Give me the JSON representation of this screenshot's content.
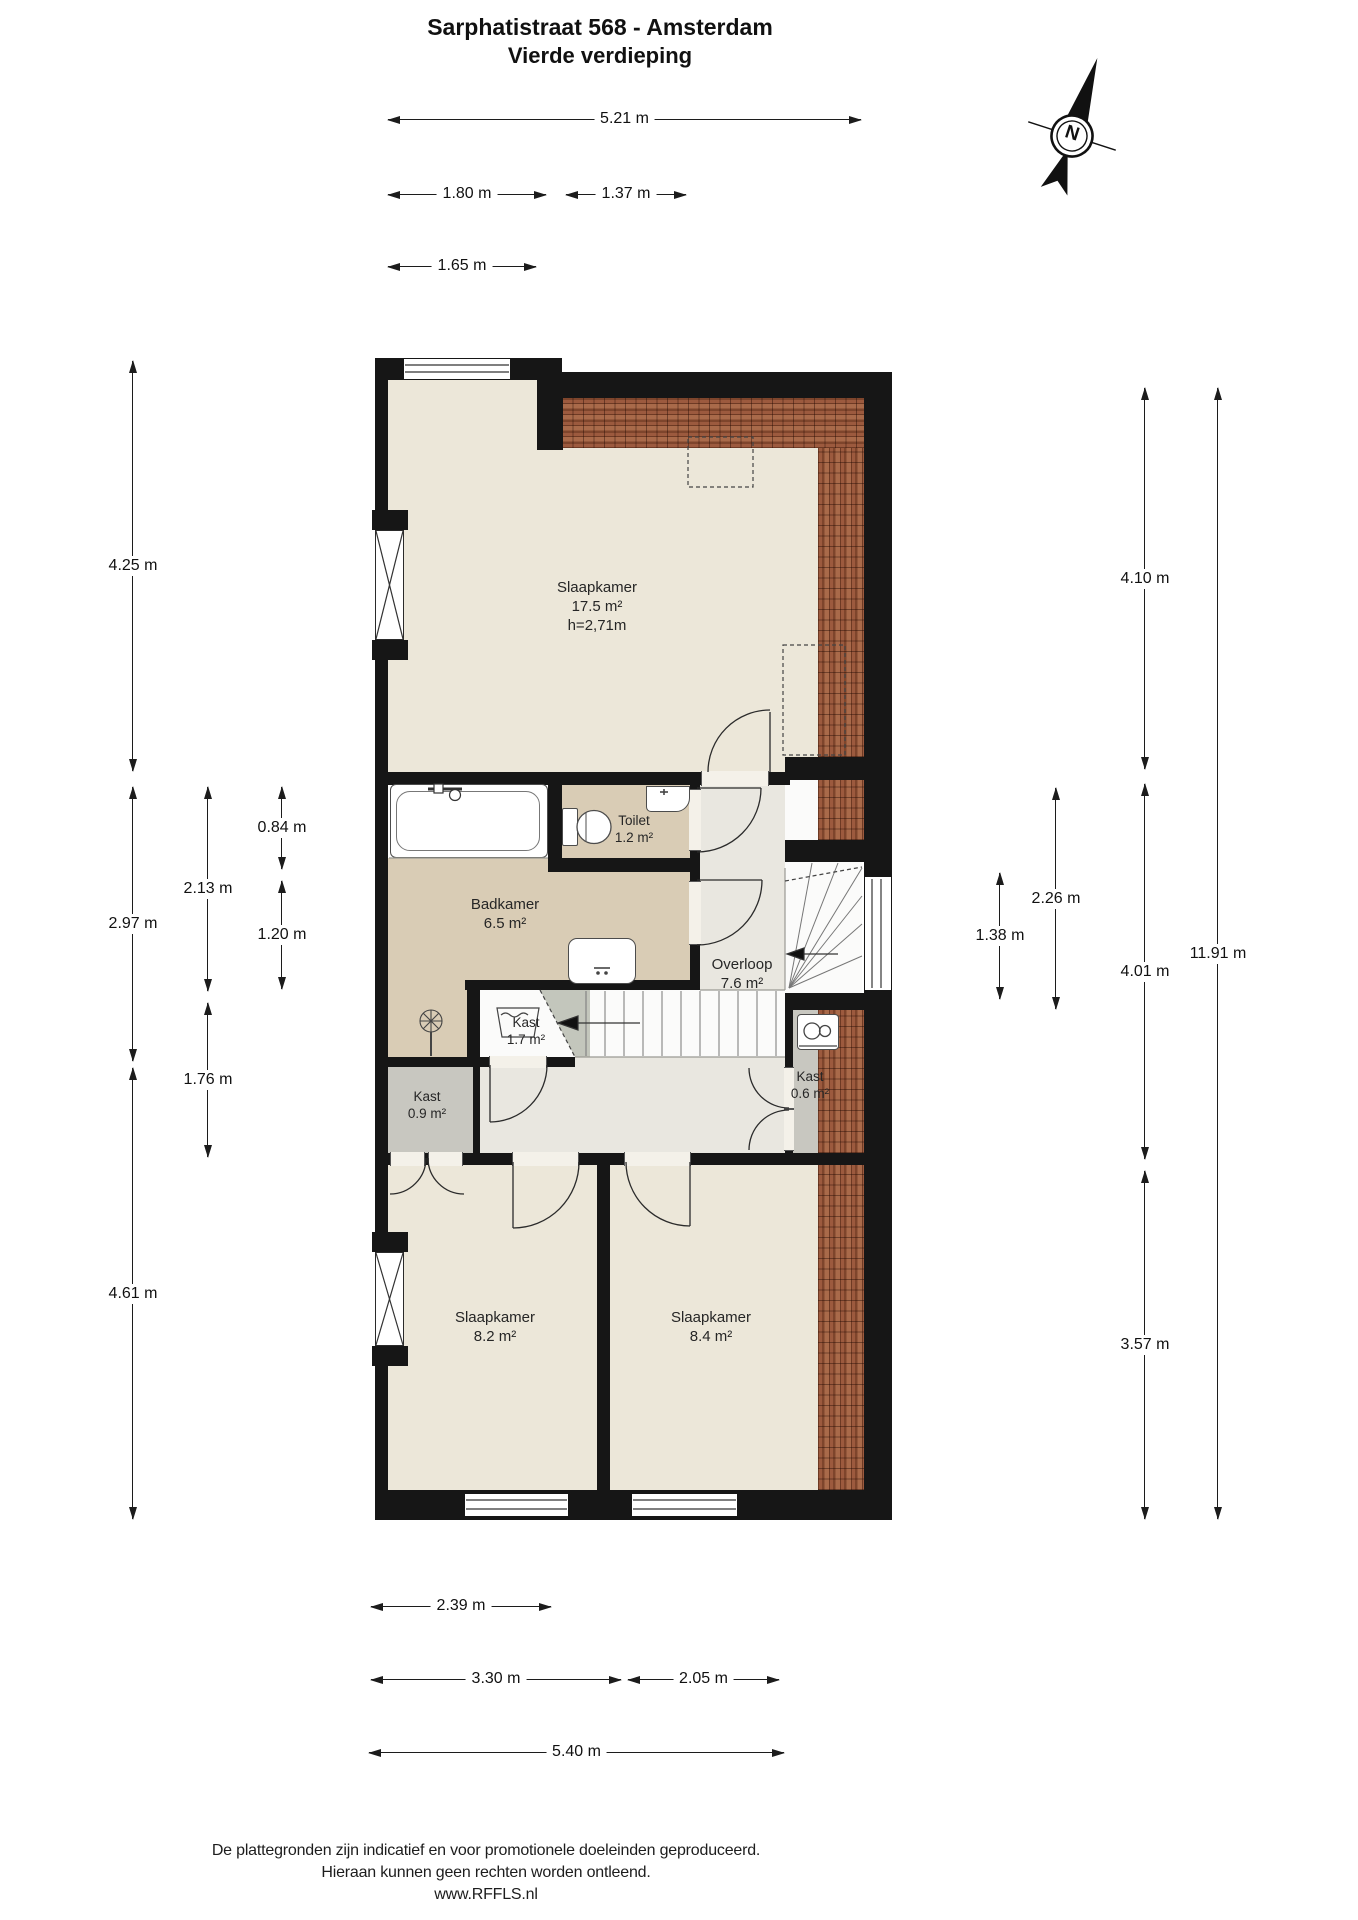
{
  "title": {
    "line1": "Sarphatistraat 568 - Amsterdam",
    "line2": "Vierde verdieping"
  },
  "compass": {
    "letter": "N"
  },
  "rooms": [
    {
      "id": "slaapkamer-groot",
      "name": "Slaapkamer",
      "area": "17.5 m²",
      "ceiling": "h=2,71m"
    },
    {
      "id": "toilet",
      "name": "Toilet",
      "area": "1.2 m²"
    },
    {
      "id": "badkamer",
      "name": "Badkamer",
      "area": "6.5 m²"
    },
    {
      "id": "overloop",
      "name": "Overloop",
      "area": "7.6 m²"
    },
    {
      "id": "kast-1",
      "name": "Kast",
      "area": "1.7 m²"
    },
    {
      "id": "kast-2",
      "name": "Kast",
      "area": "0.9 m²"
    },
    {
      "id": "kast-3",
      "name": "Kast",
      "area": "0.6 m²"
    },
    {
      "id": "slaapkamer-links",
      "name": "Slaapkamer",
      "area": "8.2 m²"
    },
    {
      "id": "slaapkamer-rechts",
      "name": "Slaapkamer",
      "area": "8.4 m²"
    }
  ],
  "dims": {
    "top": [
      "5.21 m",
      "1.80 m",
      "1.37 m",
      "1.65 m"
    ],
    "bottom": [
      "2.39 m",
      "3.30 m",
      "2.05 m",
      "5.40 m"
    ],
    "left": [
      "4.25 m",
      "2.97 m",
      "4.61 m",
      "2.13 m",
      "1.76 m",
      "0.84 m",
      "1.20 m"
    ],
    "right": [
      "4.10 m",
      "4.01 m",
      "3.57 m",
      "2.26 m",
      "1.38 m",
      "11.91 m"
    ]
  },
  "footer": {
    "line1": "De plattegronden zijn indicatief en voor promotionele doeleinden geproduceerd.",
    "line2": "Hieraan kunnen geen rechten worden ontleend.",
    "line3": "www.RFFLS.nl"
  },
  "colors": {
    "wall": "#161616",
    "floor_cream": "#ece7d9",
    "floor_tan": "#d9ccb5",
    "floor_gray": "#c8c7c0",
    "floor_hall": "#e9e7e0",
    "roof_tiles": "#94543a"
  }
}
